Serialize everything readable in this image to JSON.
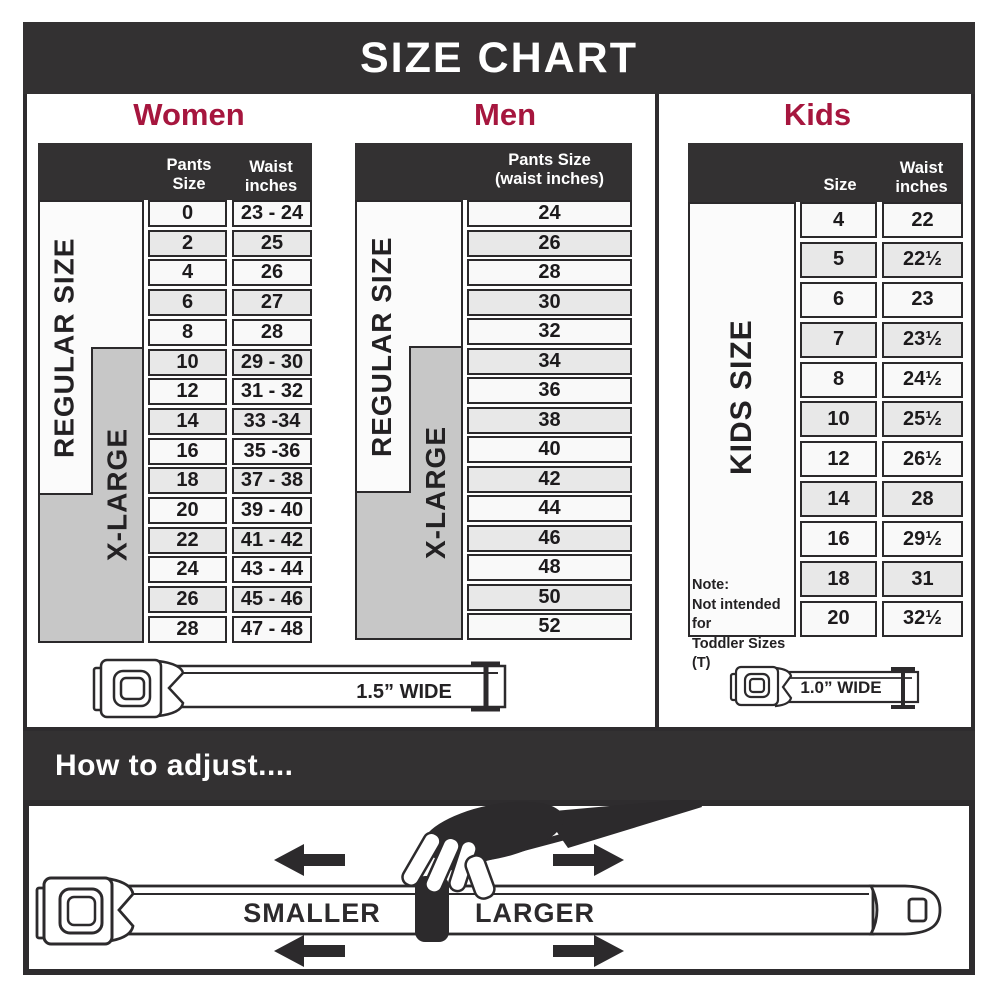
{
  "title": "SIZE CHART",
  "colors": {
    "banner": "#333132",
    "accent": "#a6163e",
    "gray_strip": "#c7c7c7",
    "row_alt": "#e8e8e8"
  },
  "sections": {
    "women": {
      "heading": "Women",
      "col1": "Pants Size",
      "col2": "Waist inches",
      "regular_label": "REGULAR SIZE",
      "xlarge_label": "X-LARGE",
      "rows": [
        {
          "size": "0",
          "waist": "23 - 24"
        },
        {
          "size": "2",
          "waist": "25"
        },
        {
          "size": "4",
          "waist": "26"
        },
        {
          "size": "6",
          "waist": "27"
        },
        {
          "size": "8",
          "waist": "28"
        },
        {
          "size": "10",
          "waist": "29 - 30"
        },
        {
          "size": "12",
          "waist": "31 - 32"
        },
        {
          "size": "14",
          "waist": "33 -34"
        },
        {
          "size": "16",
          "waist": "35 -36"
        },
        {
          "size": "18",
          "waist": "37 - 38"
        },
        {
          "size": "20",
          "waist": "39 - 40"
        },
        {
          "size": "22",
          "waist": "41 - 42"
        },
        {
          "size": "24",
          "waist": "43 - 44"
        },
        {
          "size": "26",
          "waist": "45 - 46"
        },
        {
          "size": "28",
          "waist": "47 - 48"
        }
      ]
    },
    "men": {
      "heading": "Men",
      "col1_line1": "Pants Size",
      "col1_line2": "(waist inches)",
      "regular_label": "REGULAR SIZE",
      "xlarge_label": "X-LARGE",
      "rows": [
        "24",
        "26",
        "28",
        "30",
        "32",
        "34",
        "36",
        "38",
        "40",
        "42",
        "44",
        "46",
        "48",
        "50",
        "52"
      ]
    },
    "kids": {
      "heading": "Kids",
      "col1": "Size",
      "col2": "Waist inches",
      "label": "KIDS SIZE",
      "note_title": "Note:",
      "note_line1": "Not intended for",
      "note_line2": "Toddler Sizes (T)",
      "rows": [
        {
          "size": "4",
          "waist": "22"
        },
        {
          "size": "5",
          "waist": "22½"
        },
        {
          "size": "6",
          "waist": "23"
        },
        {
          "size": "7",
          "waist": "23½"
        },
        {
          "size": "8",
          "waist": "24½"
        },
        {
          "size": "10",
          "waist": "25½"
        },
        {
          "size": "12",
          "waist": "26½"
        },
        {
          "size": "14",
          "waist": "28"
        },
        {
          "size": "16",
          "waist": "29½"
        },
        {
          "size": "18",
          "waist": "31"
        },
        {
          "size": "20",
          "waist": "32½"
        }
      ]
    }
  },
  "belts": {
    "adult_width_label": "1.5” WIDE",
    "kids_width_label": "1.0” WIDE"
  },
  "adjust": {
    "heading": "How to adjust....",
    "smaller_label": "SMALLER",
    "larger_label": "LARGER"
  }
}
